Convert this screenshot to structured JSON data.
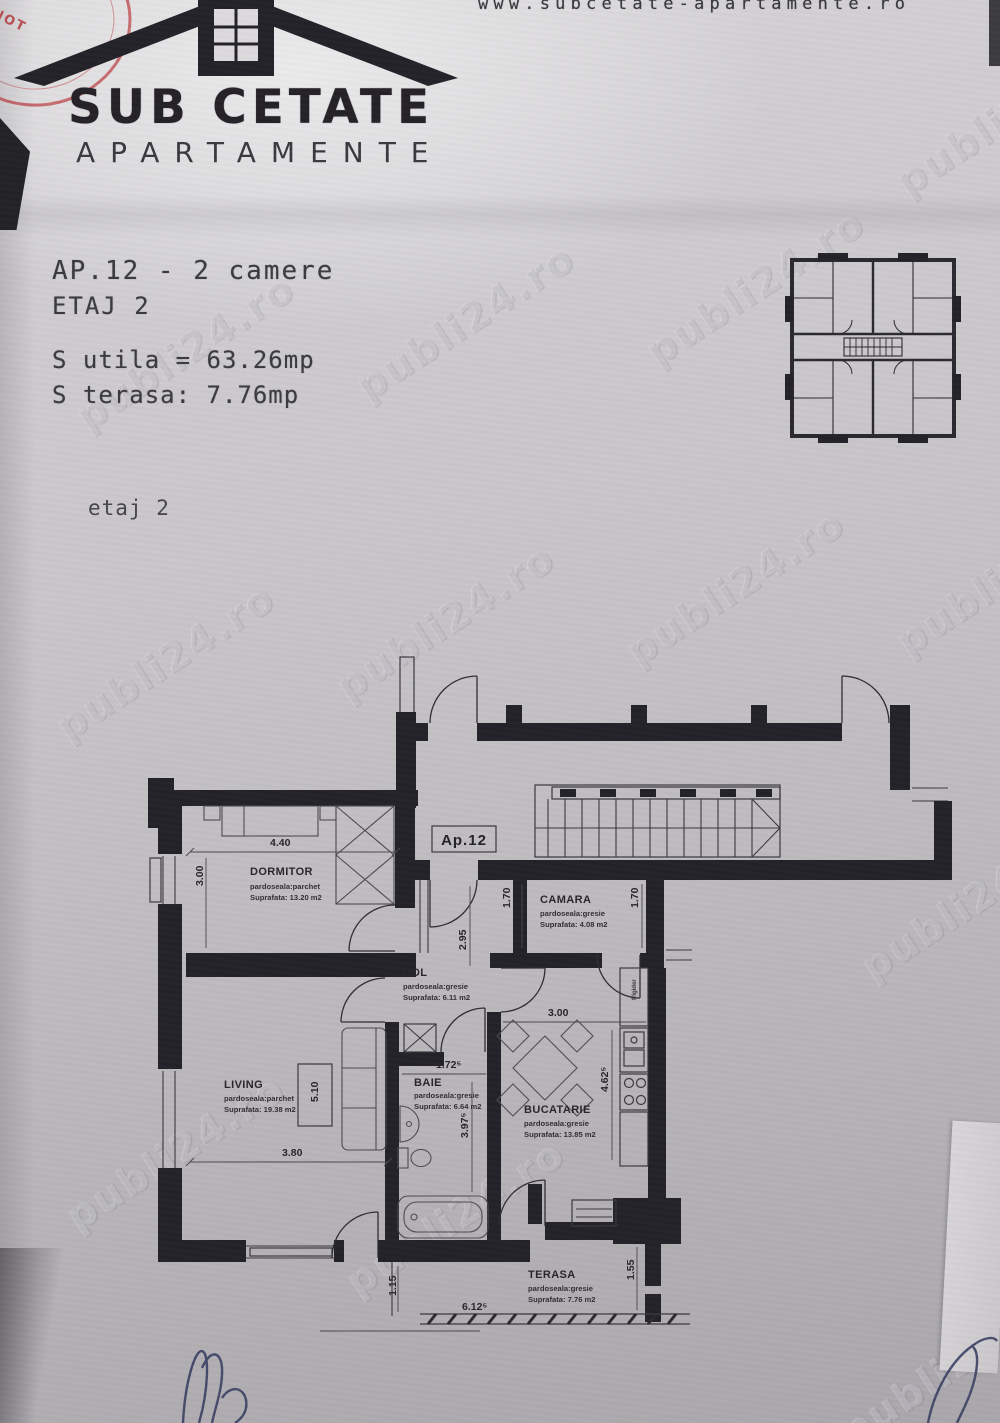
{
  "header": {
    "url": "www.subcetate-apartamente.ro",
    "logo_title": "SUB CETATE",
    "logo_subtitle": "APARTAMENTE"
  },
  "stamp": {
    "text_top": "A S",
    "text_bottom": "IN - NOT"
  },
  "listing": {
    "title": "AP.12 - 2 camere",
    "floor": "ETAJ 2",
    "usable_area": "S utila = 63.26mp",
    "terrace_area": "S terasa: 7.76mp",
    "plan_caption": "etaj 2"
  },
  "plan": {
    "unit_label": "Ap.12",
    "fridge_label": "frigider",
    "rooms": [
      {
        "name": "DORMITOR",
        "floor": "pardoseala:parchet",
        "area": "Suprafata: 13.20 m2"
      },
      {
        "name": "CAMARA",
        "floor": "pardoseala:gresie",
        "area": "Suprafata: 4.08 m2"
      },
      {
        "name": "HOL",
        "floor": "pardoseala:gresie",
        "area": "Suprafata: 6.11 m2"
      },
      {
        "name": "LIVING",
        "floor": "pardoseala:parchet",
        "area": "Suprafata: 19.38 m2"
      },
      {
        "name": "BAIE",
        "floor": "pardoseala:gresie",
        "area": "Suprafata: 6.64 m2"
      },
      {
        "name": "BUCATARIE",
        "floor": "pardoseala:gresie",
        "area": "Suprafata: 13.85 m2"
      },
      {
        "name": "TERASA",
        "floor": "pardoseala:gresie",
        "area": "Suprafata: 7.76 m2"
      }
    ],
    "dimensions": [
      "4.40",
      "3.00",
      "1.70",
      "1.70",
      "2.95",
      "3.00",
      "1.72⁵",
      "3.97⁵",
      "5.10",
      "3.80",
      "4.62⁵",
      "6.12⁵",
      "1.15",
      "1.55"
    ]
  },
  "watermark": "publi24.ro"
}
